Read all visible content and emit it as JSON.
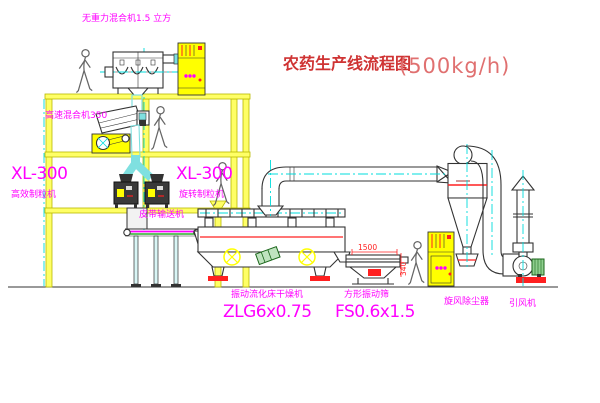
{
  "title": {
    "text": "农药生产线流程图",
    "capacity": "(500kg/h)"
  },
  "labels": {
    "mixer1": "无重力混合机1.5 立方",
    "mixer2": "高速混合机350",
    "granulator_model_left": "XL-300",
    "granulator_left": "高效制粒机",
    "granulator_model_right": "XL-300",
    "granulator_right": "旋转制粒机",
    "belt_conveyor": "皮带输送机",
    "dryer": "振动流化床干燥机",
    "dryer_model": "ZLG6x0.75",
    "screen": "方形振动筛",
    "screen_model": "FS0.6x1.5",
    "cyclone": "旋风除尘器",
    "fan": "引风机"
  },
  "dimensions": {
    "screen_length": "1500",
    "screen_height": "340"
  },
  "colors": {
    "background": "#ffffff",
    "structure_fill": "#ffff66",
    "structure_stroke": "#b9b900",
    "centerline_cyan": "#00dcdc",
    "chute_cyan": "#7fe0e0",
    "equipment_outline": "#333333",
    "label_magenta": "#ff00ff",
    "title_red": "#cf3333",
    "title_light_red": "#e07070",
    "accent_red": "#ff2020",
    "cabinet_yellow": "#ffff00",
    "motor_green": "#1a661a",
    "belt_green": "#00a000",
    "person_gray": "#666666"
  }
}
